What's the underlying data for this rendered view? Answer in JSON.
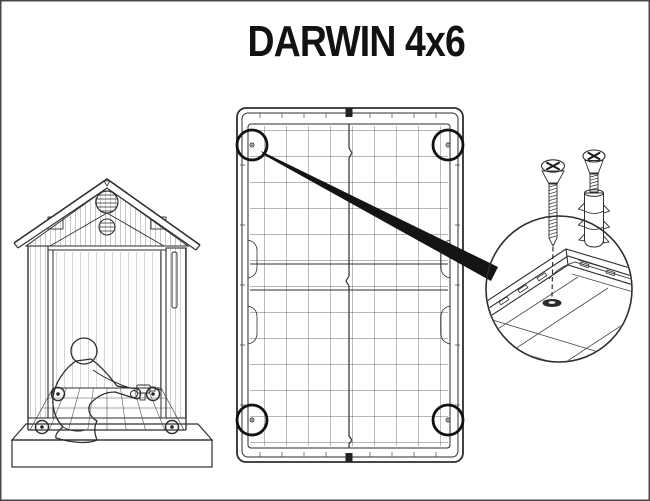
{
  "title": "DARWIN 4x6",
  "colors": {
    "background": "#ffffff",
    "frame_border": "#474747",
    "line": "#2e2e2e",
    "accent": "#141414",
    "slab_front_fill": "#e8e8e8",
    "slab_top_fill": "#f3f3f3"
  },
  "scene": {
    "floor_panel": {
      "corner_fixing_points": 4
    },
    "shed_interior": {
      "floor_screw_markers": 4
    },
    "hardware": {
      "screw_icon": "countersunk-phillips-screw",
      "anchor_icon": "wall-plug-anchor",
      "hole_icon": "anchor-hole"
    }
  }
}
